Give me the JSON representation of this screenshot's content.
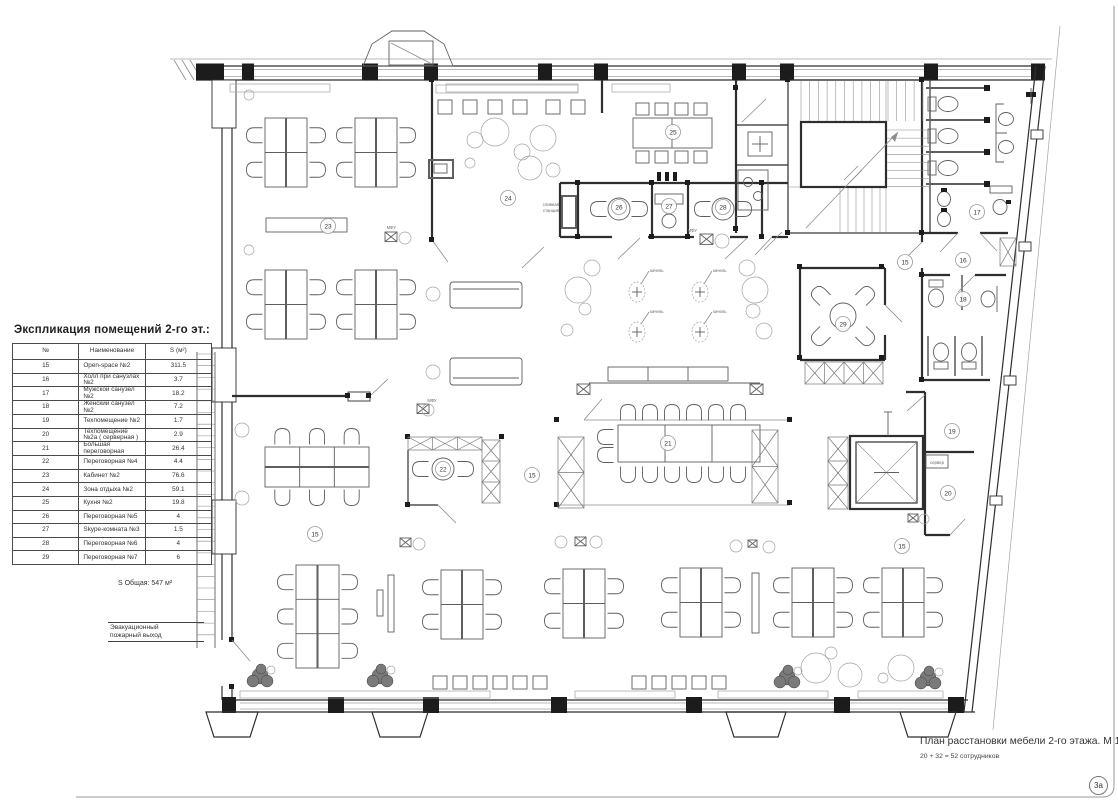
{
  "legend": {
    "title": "Экспликация помещений 2-го эт.:",
    "columns": [
      "№",
      "Наименование",
      "S (м²)"
    ],
    "rows": [
      [
        "15",
        "Open-space №2",
        "311.5"
      ],
      [
        "16",
        "Холл при санузлах №2",
        "3.7"
      ],
      [
        "17",
        "Мужской санузел №2",
        "18.2"
      ],
      [
        "18",
        "Женский санузел №2",
        "7.2"
      ],
      [
        "19",
        "Техпомещение №2",
        "1.7"
      ],
      [
        "20",
        "Техпомещение №2а ( серверная )",
        "2.9"
      ],
      [
        "21",
        "Большая переговорная",
        "26.4"
      ],
      [
        "22",
        "Переговорная №4",
        "4.4"
      ],
      [
        "23",
        "Кабинет №2",
        "76.6"
      ],
      [
        "24",
        "Зона отдыха №2",
        "59.1"
      ],
      [
        "25",
        "Кухня №2",
        "19.8"
      ],
      [
        "26",
        "Переговорная №5",
        "4"
      ],
      [
        "27",
        "Skype-комната №3",
        "1.5"
      ],
      [
        "28",
        "Переговорная №6",
        "4"
      ],
      [
        "29",
        "Переговорная №7",
        "6"
      ]
    ],
    "total": "S  Общая:  547 м²"
  },
  "titleblock": {
    "title": "План расстановки мебели 2-го этажа. М 1:100",
    "subtitle": "20 + 32 = 52 сотрудников",
    "sheet": "3а"
  },
  "annotations": {
    "fire_exit": [
      "Эвакуационный",
      "пожарный выход"
    ]
  },
  "plan": {
    "room_labels": [
      {
        "id": "15",
        "x": 315,
        "y": 534
      },
      {
        "id": "15",
        "x": 532,
        "y": 475
      },
      {
        "id": "15",
        "x": 905,
        "y": 262
      },
      {
        "id": "15",
        "x": 902,
        "y": 546
      },
      {
        "id": "16",
        "x": 963,
        "y": 260
      },
      {
        "id": "17",
        "x": 977,
        "y": 212
      },
      {
        "id": "18",
        "x": 963,
        "y": 299
      },
      {
        "id": "19",
        "x": 952,
        "y": 431
      },
      {
        "id": "20",
        "x": 948,
        "y": 493
      },
      {
        "id": "21",
        "x": 668,
        "y": 443
      },
      {
        "id": "22",
        "x": 443,
        "y": 469
      },
      {
        "id": "23",
        "x": 328,
        "y": 226
      },
      {
        "id": "24",
        "x": 508,
        "y": 198
      },
      {
        "id": "25",
        "x": 673,
        "y": 132
      },
      {
        "id": "26",
        "x": 619,
        "y": 207
      },
      {
        "id": "27",
        "x": 669,
        "y": 206
      },
      {
        "id": "28",
        "x": 723,
        "y": 207
      },
      {
        "id": "29",
        "x": 843,
        "y": 324
      }
    ],
    "plan_texts": [
      {
        "text": "качель",
        "x": 650,
        "y": 272,
        "anchor": "start"
      },
      {
        "text": "качель",
        "x": 713,
        "y": 272,
        "anchor": "start"
      },
      {
        "text": "качель",
        "x": 650,
        "y": 313,
        "anchor": "start"
      },
      {
        "text": "качель",
        "x": 713,
        "y": 313,
        "anchor": "start"
      },
      {
        "text": "сливная",
        "x": 559,
        "y": 206,
        "anchor": "end"
      },
      {
        "text": "станция",
        "x": 559,
        "y": 212,
        "anchor": "end"
      },
      {
        "text": "сервер",
        "x": 937,
        "y": 464,
        "anchor": "middle"
      },
      {
        "text": "МФУ",
        "x": 396,
        "y": 229,
        "anchor": "end"
      },
      {
        "text": "МФУ",
        "x": 432,
        "y": 402,
        "anchor": "middle"
      },
      {
        "text": "МФУ",
        "x": 697,
        "y": 232,
        "anchor": "end"
      }
    ]
  },
  "colors": {
    "ink": "#2e2e2e",
    "furniture": "#5f5f5f",
    "light": "#a3a3a3"
  }
}
